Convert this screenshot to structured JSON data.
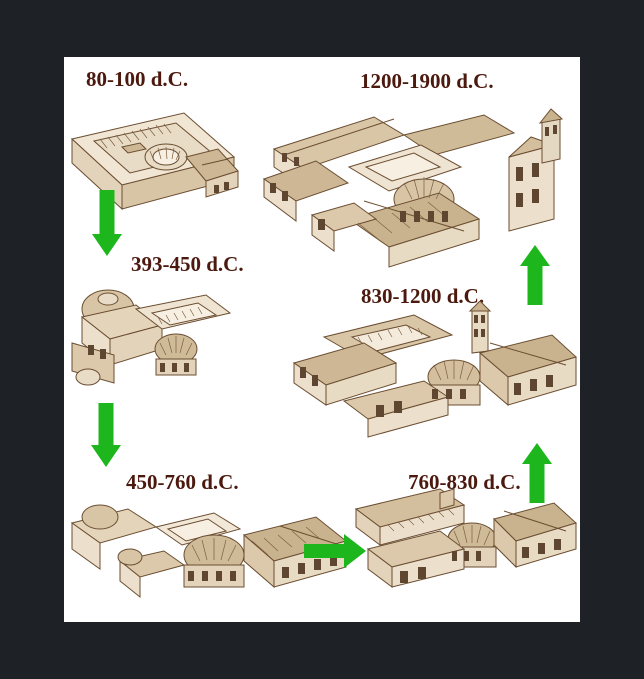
{
  "window": {
    "background": "#1e2126",
    "panel_background": "#ffffff"
  },
  "colors": {
    "arrow_green": "#1db71d",
    "label_text": "#4b190e",
    "sketch_ink": "#6b4d31"
  },
  "diagram": {
    "type": "building-evolution-timeline",
    "stages": [
      {
        "label": "80-100 d.C."
      },
      {
        "label": "393-450 d.C."
      },
      {
        "label": "450-760 d.C."
      },
      {
        "label": "760-830 d.C."
      },
      {
        "label": "830-1200 d.C."
      },
      {
        "label": "1200-1900 d.C."
      }
    ],
    "arrows": [
      {
        "from": "80-100 d.C.",
        "to": "393-450 d.C.",
        "direction": "down"
      },
      {
        "from": "393-450 d.C.",
        "to": "450-760 d.C.",
        "direction": "down"
      },
      {
        "from": "450-760 d.C.",
        "to": "760-830 d.C.",
        "direction": "right"
      },
      {
        "from": "760-830 d.C.",
        "to": "830-1200 d.C.",
        "direction": "up"
      },
      {
        "from": "830-1200 d.C.",
        "to": "1200-1900 d.C.",
        "direction": "up"
      }
    ]
  }
}
